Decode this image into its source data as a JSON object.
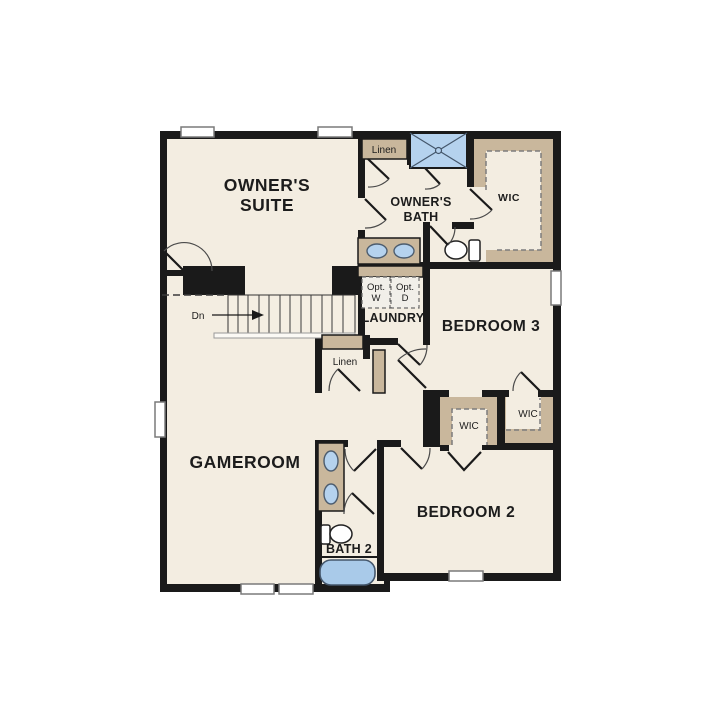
{
  "palette": {
    "wall": "#1a1a1a",
    "floor": "#f3ede1",
    "casework_tan": "#c9b79c",
    "fixture_blue": "#b5d2ee",
    "background": "#ffffff"
  },
  "rooms": {
    "owners_suite": {
      "label_line1": "OWNER'S",
      "label_line2": "SUITE"
    },
    "owners_bath": {
      "label_line1": "OWNER'S",
      "label_line2": "BATH"
    },
    "linen_top": {
      "label": "Linen"
    },
    "wic_owners": {
      "label": "WIC"
    },
    "laundry": {
      "label": "LAUNDRY",
      "opt_washer_line1": "Opt.",
      "opt_washer_line2": "W",
      "opt_dryer_line1": "Opt.",
      "opt_dryer_line2": "D"
    },
    "bedroom3": {
      "label": "BEDROOM 3"
    },
    "stairs": {
      "label": "Dn"
    },
    "linen_mid": {
      "label": "Linen"
    },
    "gameroom": {
      "label": "GAMEROOM"
    },
    "wic_bedroom3": {
      "label": "WIC"
    },
    "wic_bedroom2": {
      "label": "WIC"
    },
    "bath2": {
      "label": "BATH 2"
    },
    "bedroom2": {
      "label": "BEDROOM 2"
    }
  }
}
